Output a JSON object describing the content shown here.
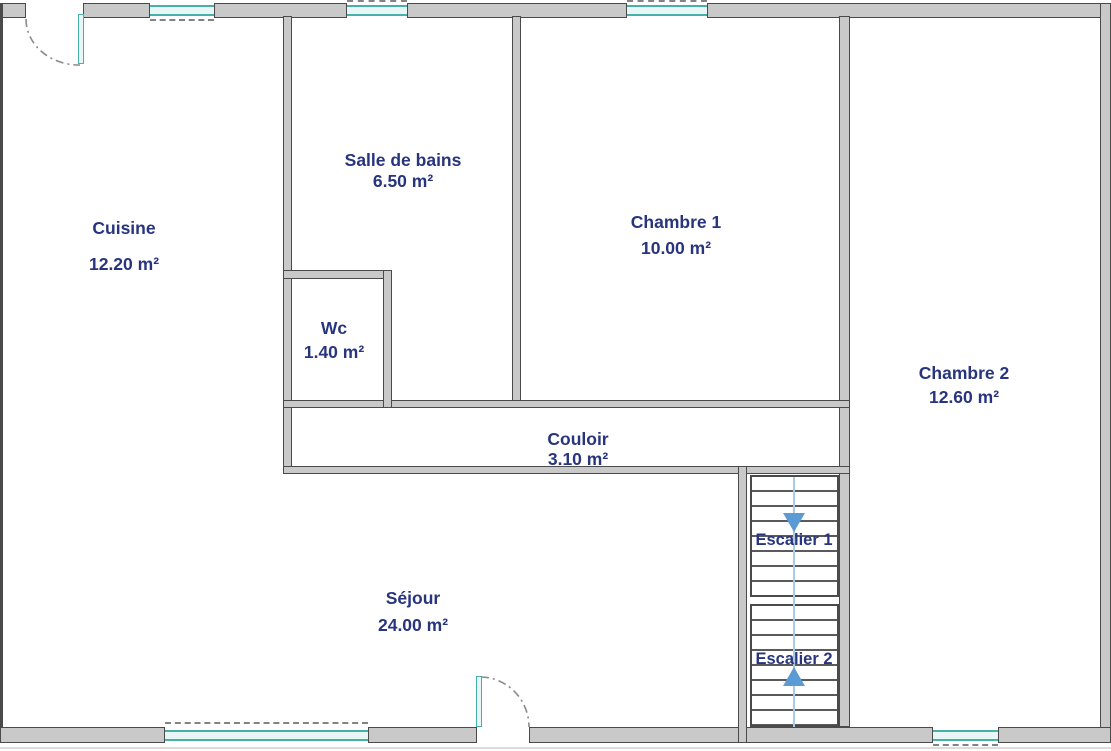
{
  "rooms": {
    "cuisine": {
      "name": "Cuisine",
      "area": "12.20 m²"
    },
    "salle_de_bains": {
      "name": "Salle de bains",
      "area": "6.50 m²"
    },
    "wc": {
      "name": "Wc",
      "area": "1.40 m²"
    },
    "chambre1": {
      "name": "Chambre 1",
      "area": "10.00 m²"
    },
    "chambre2": {
      "name": "Chambre 2",
      "area": "12.60 m²"
    },
    "couloir": {
      "name": "Couloir",
      "area": "3.10 m²"
    },
    "sejour": {
      "name": "Séjour",
      "area": "24.00 m²"
    }
  },
  "stairs": {
    "escalier1": {
      "label": "Escalier 1",
      "direction": "down"
    },
    "escalier2": {
      "label": "Escalier 2",
      "direction": "up"
    }
  },
  "colors": {
    "wall-fill": "#c9c9c9",
    "wall-edge": "#4a4a4a",
    "window-frame": "#47b0a8",
    "window-fill": "#e8f6f5",
    "label": "#28357e",
    "stair-line": "#a9cbe8",
    "arrow": "#5b9bd5",
    "tread": "#5a5a5a"
  }
}
